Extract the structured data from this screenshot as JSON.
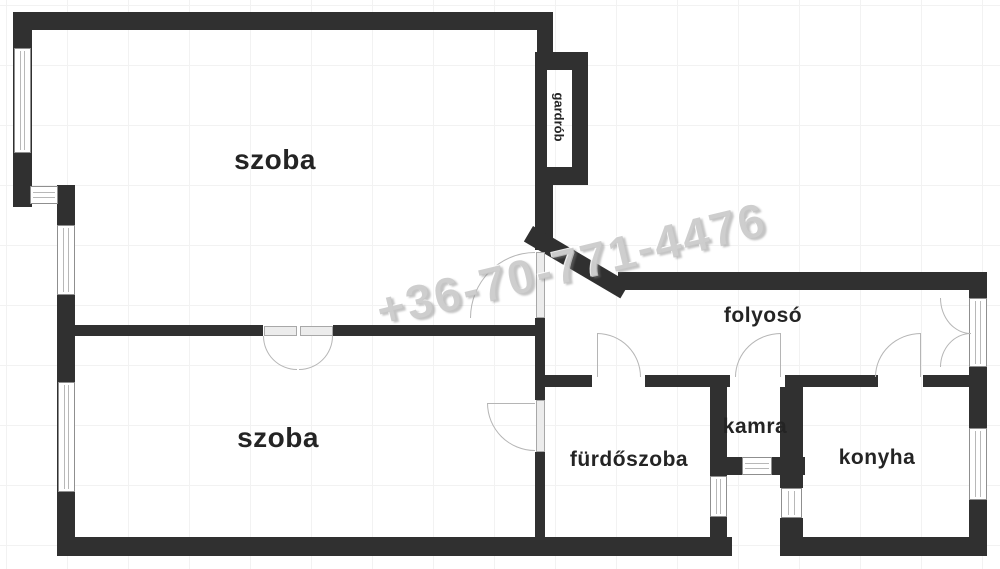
{
  "watermark": {
    "text": "+36-70-771-4476"
  },
  "rooms": {
    "room_top": {
      "label": "szoba"
    },
    "room_bottom": {
      "label": "szoba"
    },
    "wardrobe": {
      "label": "gardrób"
    },
    "hallway": {
      "label": "folyosó"
    },
    "bathroom": {
      "label": "fürdőszoba"
    },
    "pantry": {
      "label": "kamra"
    },
    "kitchen": {
      "label": "konyha"
    }
  },
  "colors": {
    "wall": "#303030",
    "window_frame": "#8f8f8f",
    "door_arc": "#b5b5b5",
    "label": "#242424",
    "grid": "#f2f2f2",
    "watermark": "#c6c6c6"
  }
}
